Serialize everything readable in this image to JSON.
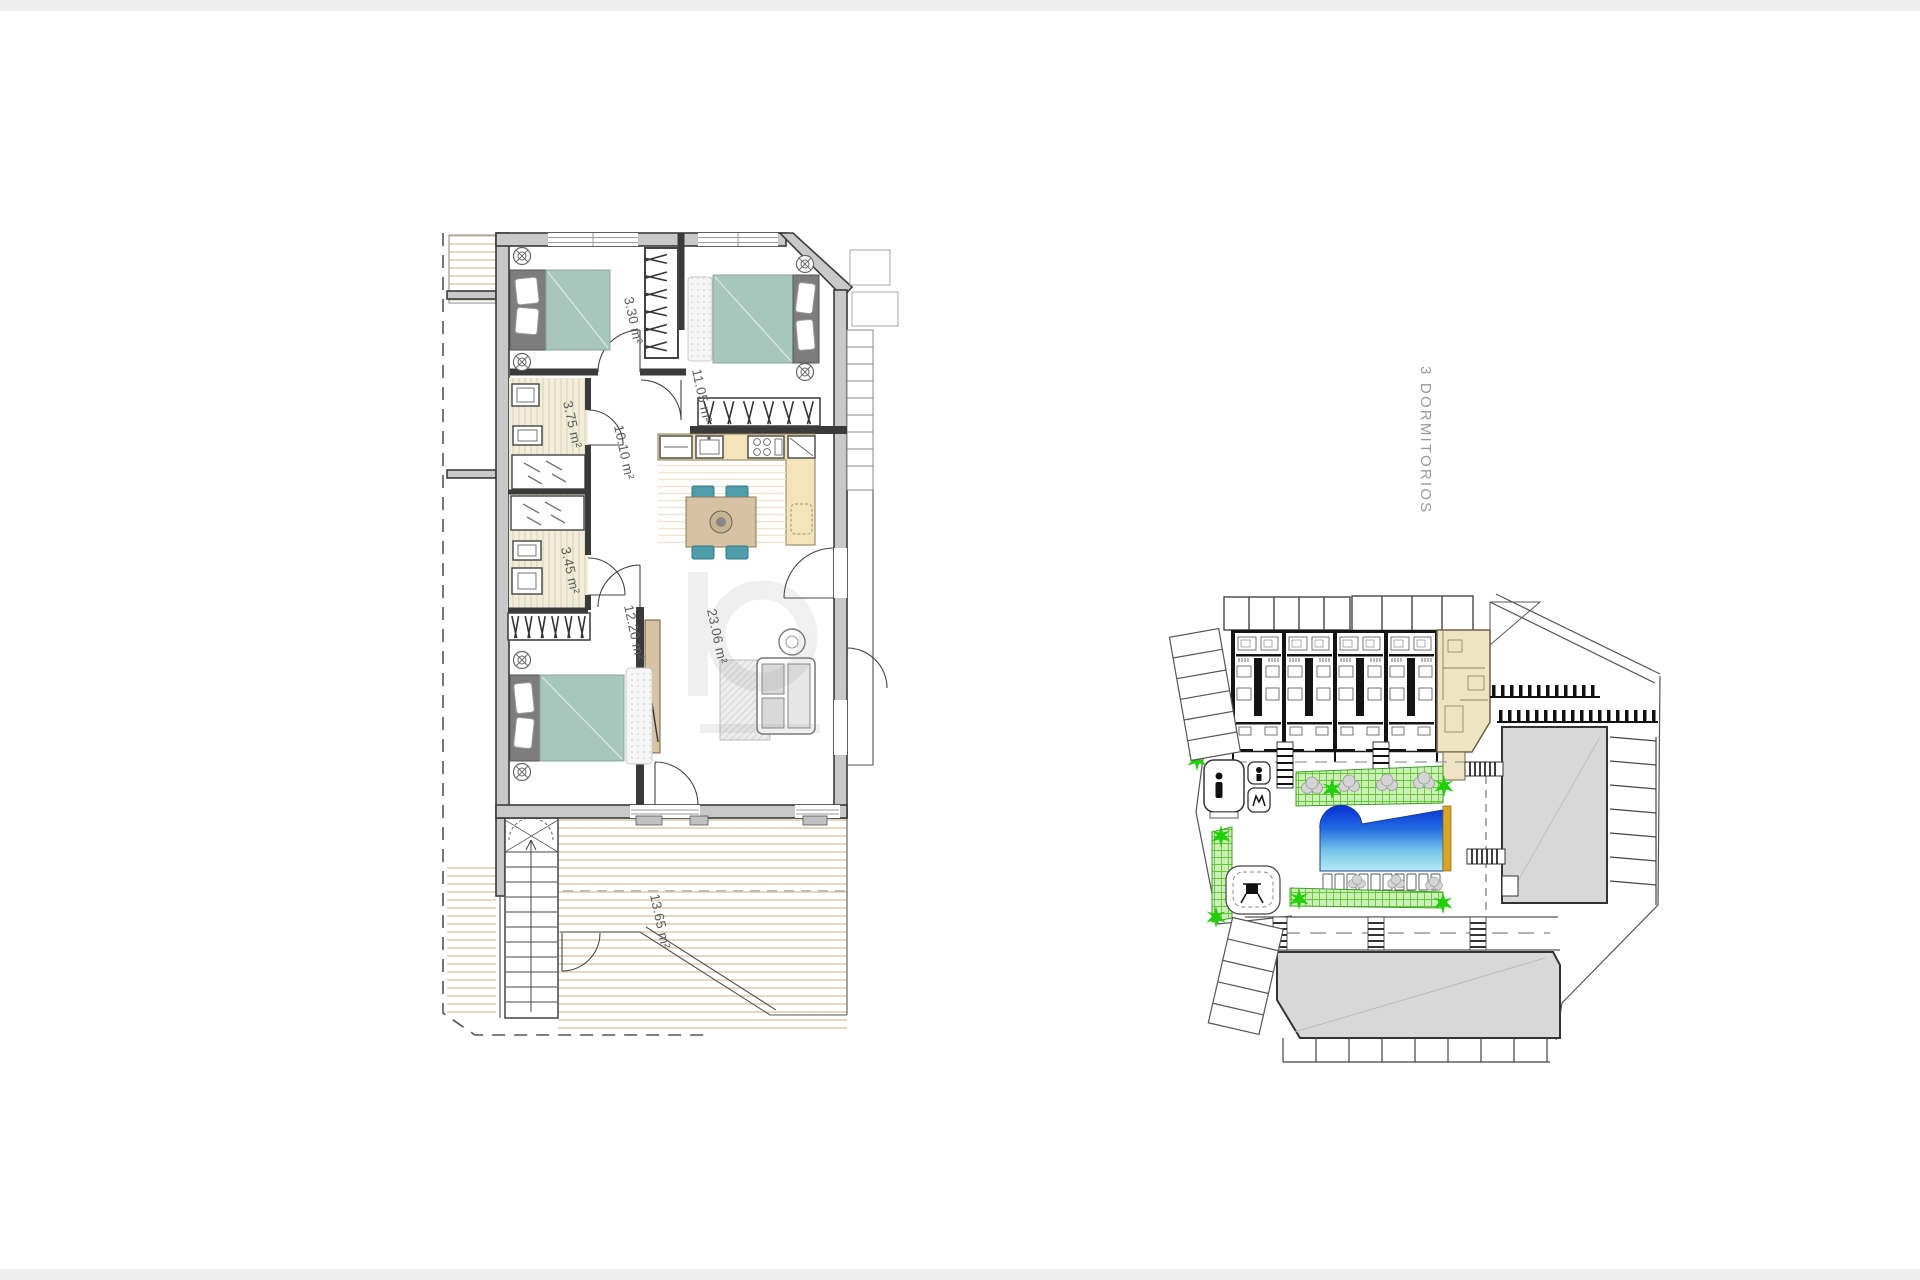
{
  "page": {
    "background": "#ffffff"
  },
  "floor_plan": {
    "rooms": [
      {
        "name": "wardrobe-master",
        "area": "3.30 m²"
      },
      {
        "name": "bedroom-2",
        "area": "11.05 m²"
      },
      {
        "name": "bathroom-1",
        "area": "3.75 m²"
      },
      {
        "name": "hallway",
        "area": "10.10 m²"
      },
      {
        "name": "bathroom-2",
        "area": "3.45 m²"
      },
      {
        "name": "bedroom-3",
        "area": "12.20 m²"
      },
      {
        "name": "living-dining",
        "area": "23.06 m²"
      },
      {
        "name": "terrace",
        "area": "13.65 m²"
      }
    ]
  },
  "site_plan": {
    "title": "3 DORMITORIOS",
    "icons": [
      "palm-tree",
      "hedge",
      "swimming-pool",
      "sun-lounger",
      "toilets",
      "playground",
      "stairs",
      "parking",
      "crosswalk",
      "apartment-block",
      "highlighted-unit",
      "neighbor-building"
    ]
  },
  "colors": {
    "edge_band": "#ededed",
    "wall_fill": "#c9c9c9",
    "wall_stroke": "#3a3a3a",
    "bed": "#a8c6bb",
    "headboard": "#7d7d7d",
    "chair": "#4f9dab",
    "wood": "#d7c2a3",
    "counter": "#f5e4ba",
    "bath_floor": "#f1edda",
    "floor_stripe": "#d8d1b3",
    "pool_edge": "#d8a42a",
    "green": "#21cf08",
    "green_fill": "#cdeeb8",
    "green_line": "#5ec930",
    "site_gray": "#d8d8d8",
    "highlight": "#eee3c3",
    "label": "#5c5c5c",
    "title": "#9a9a9a"
  }
}
